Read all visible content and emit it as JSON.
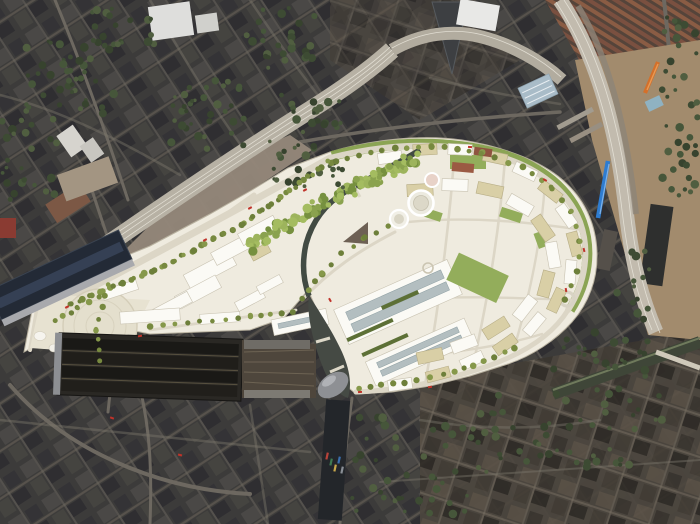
{
  "image": {
    "kind": "aerial-photograph",
    "subject": "dense-city-district-with-white-masterplan-render-overlay",
    "width_px": 700,
    "height_px": 524
  },
  "palette": {
    "fabric_base": "#3c3b3a",
    "fabric_warm": "#4c463e",
    "masterplan_ground": "#efebdf",
    "plaza_ground": "#e7e2d1",
    "building_white": "#fbfaf5",
    "building_cream": "#d9cfa6",
    "lawn_green": "#93ad5b",
    "verge_green": "#7f9c45",
    "tree_olive": "#7d8f44",
    "tree_dark": "#42503a",
    "canal_water": "#424b43",
    "basin_water": "#23262a",
    "rail_bed": "#b7b1a4",
    "construction_dirt": "#a28b6d",
    "construction_dirt_nw": "#95887a",
    "terrace_roof": "#8a5c44",
    "trainshed_dark": "#2a2824",
    "stpancras_roof": "#232a36",
    "warehouse_blue_roof": "#a9bcc8",
    "train_orange": "#d4702a",
    "train_blue": "#2e7cd0",
    "bus_red": "#c0332a",
    "road_light": "#e8e3d4",
    "oval_building_grey": "#8e9094"
  },
  "features": {
    "existing_city": "existing dark urban fabric surrounding the site",
    "masterplan": "bright white/cream development masterplan overlay in centre",
    "station_shed_large": "large dark multi-bay mainline trainshed (bottom left)",
    "station_shed_diagonal": "second diagonal dark-roofed trainshed (upper left of plaza)",
    "forecourt_plaza": "pale triangular forecourt plaza with faint circular canopy",
    "boulevard": "tree-lined boulevard running northeast from plaza",
    "canal": "canal winding through the site with green park band of trees",
    "gasholders": "circular gasholder structures near centre of masterplan",
    "arc_road": "sweeping perimeter road with green verge around north/east edge",
    "rail_corridor_nw": "pale multi-track railway corridor along northwest edge",
    "rail_corridor_e": "curving railway corridor and construction ground on east side",
    "canal_basin": "dark canal basin with moored narrowboats (bottom centre)",
    "orange_train": "orange train on eastern tracks",
    "blue_train": "blue train on eastern tracks",
    "blue_warehouse": "warehouse with pale blue roof (top right)",
    "terraces": "brown-roofed terraced housing (top right corner)",
    "buses": "small red vehicles on streets",
    "roundabout": "small roundabout at southeast corner of masterplan"
  },
  "scene": {
    "tree_dark_palette": [
      "#3d4b33",
      "#46563a",
      "#37432e",
      "#505e40"
    ],
    "tree_olive_palette": [
      "#77893f",
      "#86984a",
      "#6d7f3a"
    ],
    "park_palette": [
      "#8aa24e",
      "#9db45c",
      "#76903f",
      "#a4bc60"
    ],
    "tree_regions": [
      {
        "x": 25,
        "y": 35,
        "w": 90,
        "h": 80,
        "n": 46,
        "seed": 11
      },
      {
        "x": 165,
        "y": 80,
        "w": 80,
        "h": 70,
        "n": 34,
        "seed": 22
      },
      {
        "x": 245,
        "y": 8,
        "w": 70,
        "h": 60,
        "n": 28,
        "seed": 33
      },
      {
        "x": 268,
        "y": 95,
        "w": 75,
        "h": 95,
        "n": 46,
        "seed": 44
      },
      {
        "x": 88,
        "y": 0,
        "w": 70,
        "h": 45,
        "n": 18,
        "seed": 55
      },
      {
        "x": 0,
        "y": 118,
        "w": 58,
        "h": 88,
        "n": 24,
        "seed": 66
      },
      {
        "x": 662,
        "y": 15,
        "w": 36,
        "h": 200,
        "n": 40,
        "seed": 77
      },
      {
        "x": 470,
        "y": 388,
        "w": 195,
        "h": 85,
        "n": 56,
        "seed": 88
      },
      {
        "x": 352,
        "y": 415,
        "w": 115,
        "h": 100,
        "n": 42,
        "seed": 99
      },
      {
        "x": 553,
        "y": 330,
        "w": 105,
        "h": 48,
        "n": 22,
        "seed": 101
      },
      {
        "x": 612,
        "y": 250,
        "w": 40,
        "h": 70,
        "n": 14,
        "seed": 103
      }
    ],
    "park_band": {
      "pts": [
        [
          248,
          246
        ],
        [
          280,
          229
        ],
        [
          312,
          211
        ],
        [
          345,
          192
        ],
        [
          372,
          179
        ],
        [
          400,
          166
        ],
        [
          414,
          158
        ]
      ],
      "step": 6,
      "jitter": 6,
      "passes": 3,
      "seed": 7
    },
    "tree_rows": [
      {
        "pts": [
          [
            68,
            300
          ],
          [
            160,
            262
          ],
          [
            240,
            220
          ],
          [
            328,
            158
          ]
        ],
        "step": 11,
        "off": 5,
        "seed": 1
      },
      {
        "pts": [
          [
            74,
            308
          ],
          [
            166,
            270
          ],
          [
            246,
            228
          ],
          [
            330,
            166
          ]
        ],
        "step": 11,
        "off": -5,
        "seed": 2
      },
      {
        "pts": [
          [
            336,
            162
          ],
          [
            382,
            150
          ],
          [
            432,
            146
          ],
          [
            482,
            153
          ],
          [
            522,
            167
          ],
          [
            552,
            188
          ],
          [
            571,
            212
          ],
          [
            580,
            242
          ],
          [
            577,
            272
          ],
          [
            564,
            300
          ]
        ],
        "step": 13,
        "off": 0,
        "seed": 3
      },
      {
        "pts": [
          [
            360,
            388
          ],
          [
            404,
            383
          ],
          [
            444,
            375
          ],
          [
            484,
            362
          ],
          [
            514,
            348
          ]
        ],
        "step": 12,
        "off": 0,
        "seed": 4
      },
      {
        "pts": [
          [
            150,
            327
          ],
          [
            200,
            322
          ],
          [
            250,
            316
          ],
          [
            292,
            312
          ]
        ],
        "step": 12,
        "off": 0,
        "seed": 5
      },
      {
        "pts": [
          [
            303,
            298
          ],
          [
            322,
            274
          ],
          [
            342,
            254
          ],
          [
            364,
            238
          ],
          [
            388,
            226
          ]
        ],
        "step": 12,
        "off": 0,
        "seed": 6
      },
      {
        "pts": [
          [
            56,
            320
          ],
          [
            78,
            308
          ],
          [
            100,
            297
          ]
        ],
        "step": 10,
        "off": 0,
        "seed": 8
      },
      {
        "pts": [
          [
            108,
            285
          ],
          [
            96,
            330
          ],
          [
            100,
            360
          ]
        ],
        "step": 12,
        "off": 0,
        "seed": 9
      }
    ],
    "buses": [
      [
        67,
        307,
        -28
      ],
      [
        140,
        336,
        -10
      ],
      [
        250,
        208,
        -28
      ],
      [
        305,
        190,
        -28
      ],
      [
        360,
        392,
        -5
      ],
      [
        430,
        387,
        -8
      ],
      [
        470,
        147,
        5
      ],
      [
        545,
        180,
        30
      ],
      [
        566,
        290,
        80
      ],
      [
        584,
        250,
        75
      ],
      [
        112,
        418,
        20
      ],
      [
        180,
        455,
        15
      ],
      [
        330,
        300,
        60
      ],
      [
        205,
        240,
        -28
      ]
    ],
    "boats": [
      [
        327,
        456,
        "#b8433a"
      ],
      [
        331,
        462,
        "#3f7a52"
      ],
      [
        335,
        468,
        "#c8a84b"
      ],
      [
        339,
        460,
        "#3a6fae"
      ],
      [
        342,
        470,
        "#8a8f96"
      ]
    ]
  }
}
